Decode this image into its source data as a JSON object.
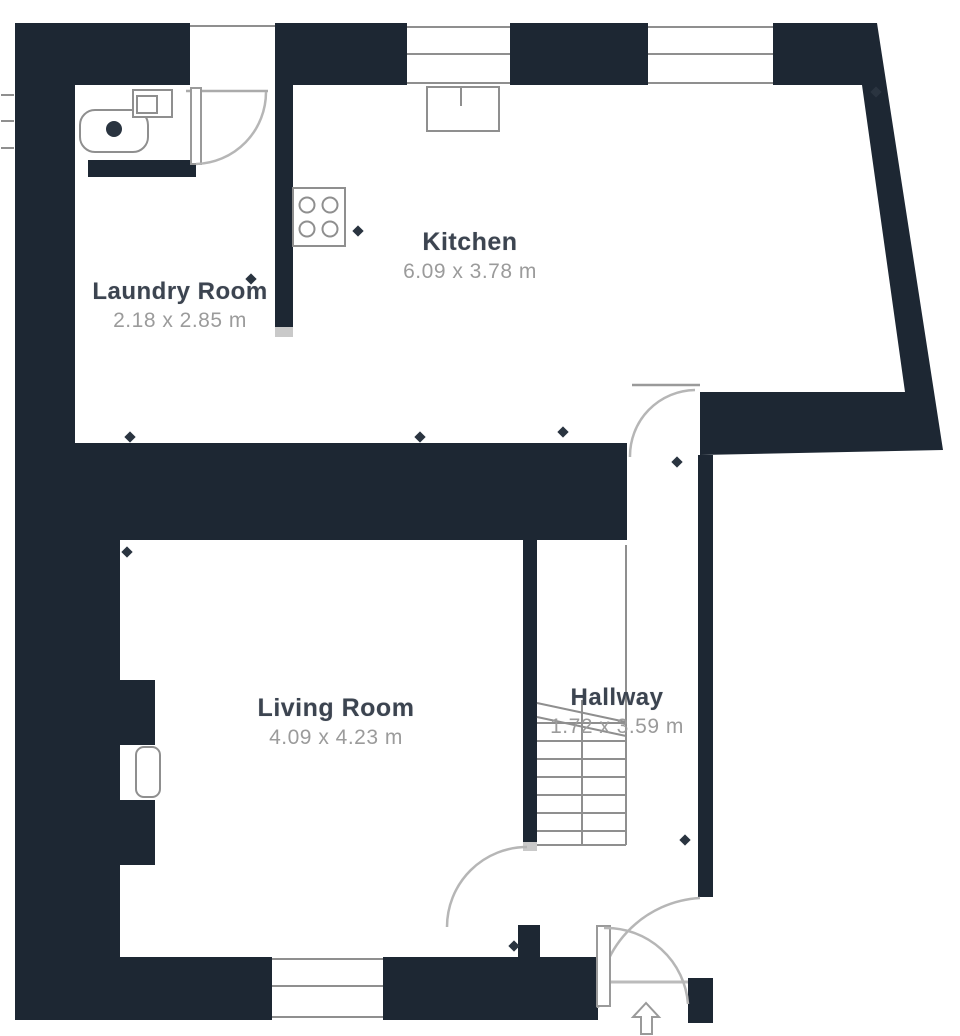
{
  "plan": {
    "type": "floor-plan",
    "rooms": {
      "kitchen": {
        "name": "Kitchen",
        "dimensions": "6.09 x 3.78 m"
      },
      "laundry": {
        "name": "Laundry Room",
        "dimensions": "2.18 x 2.85 m"
      },
      "living": {
        "name": "Living Room",
        "dimensions": "4.09 x 4.23 m"
      },
      "hallway": {
        "name": "Hallway",
        "dimensions": "1.72 x 3.59 m"
      }
    },
    "fixtures": [
      "bathtub",
      "washing-machine",
      "stove",
      "kitchen-sink",
      "fireplace",
      "staircase",
      "entrance-arrow"
    ],
    "doors": [
      "laundry-back-door",
      "kitchen-hallway-door",
      "living-room-door",
      "front-entrance-door",
      "vestibule-door"
    ],
    "windows": [
      "kitchen-top-window-left",
      "kitchen-top-window-right",
      "living-room-bottom-window",
      "laundry-side-window"
    ]
  },
  "colors": {
    "wall": "#1d2733",
    "cap": "#c9c9c9",
    "line": "#8f8f8f",
    "arc": "#b6b6b6",
    "label": "#3c4450",
    "dims": "#9b9b9b",
    "tick": "#2a3440",
    "bg": "#ffffff"
  }
}
